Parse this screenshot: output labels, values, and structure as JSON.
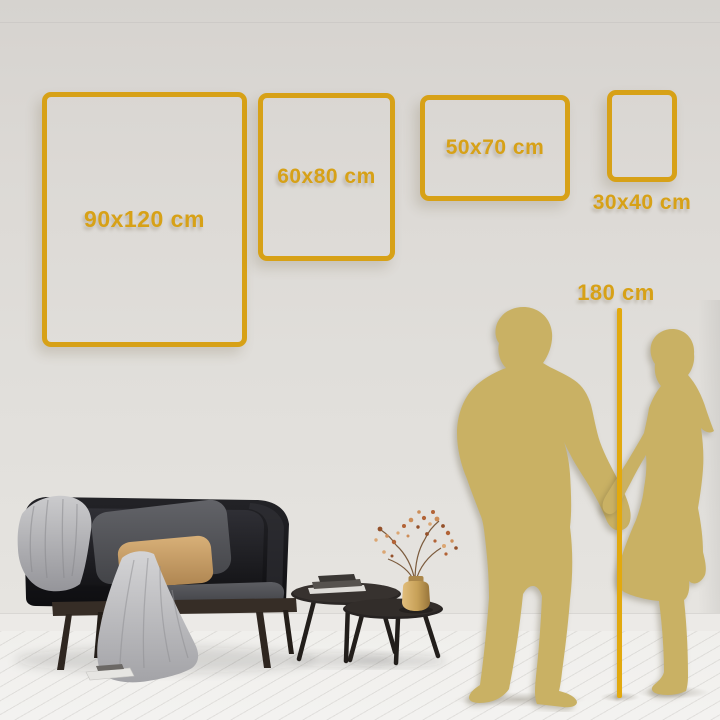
{
  "palette": {
    "accent": "#D7A117",
    "ruler": "#E2A90E",
    "silhouette": "#C9B164"
  },
  "size_guide": {
    "unit": "cm",
    "frames": [
      {
        "label": "90x120 cm",
        "orientation": "portrait"
      },
      {
        "label": "60x80 cm",
        "orientation": "portrait"
      },
      {
        "label": "50x70 cm",
        "orientation": "landscape"
      },
      {
        "label": "30x40 cm",
        "orientation": "portrait"
      }
    ],
    "height_reference": {
      "label": "180 cm"
    }
  }
}
